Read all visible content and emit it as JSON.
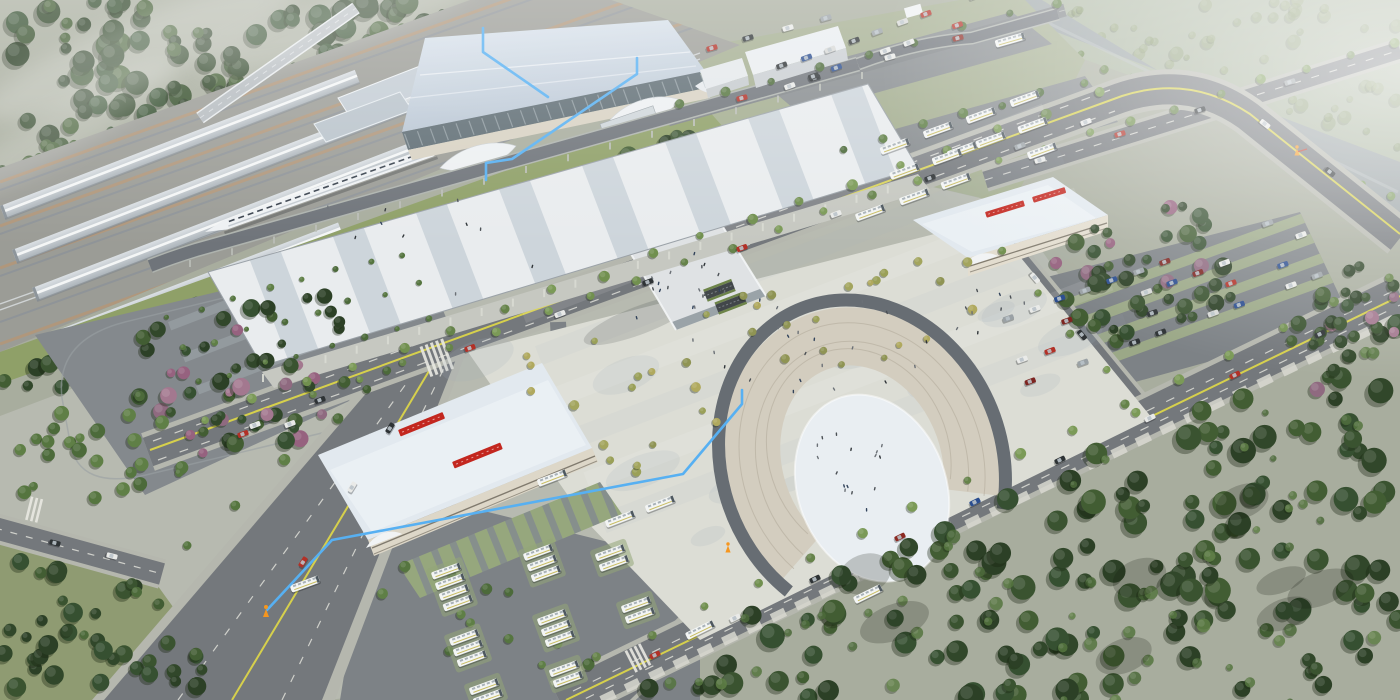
{
  "scene": {
    "type": "architectural-aerial-rendering",
    "subject": "High-speed railway station complex: station hall, platform canopies with train, striped arrival canopy, front plaza with oval horseshoe feature, bus terminal buildings, coach depot, parking lots, river and tree belts",
    "camera": "oblique bird's-eye view",
    "atmosphere": "hazy daylight"
  },
  "annotations": {
    "line_color": "#57b0f2",
    "marker_color": "#f6961e",
    "lines": [
      "station-roofline-left",
      "station-roofline-right",
      "plaza-to-bus-route"
    ],
    "markers": [
      "route-end-marker",
      "plaza-curb-marker",
      "riverside-marker"
    ]
  },
  "palette": {
    "station_roof_light": "#dde6ef",
    "station_roof_shade": "#b7c4d2",
    "canopy_stripe_light": "#e9ecee",
    "canopy_stripe_shade": "#cdd5db",
    "glass_facade": "#5f6d74",
    "building_sign_red": "#c3271f",
    "asphalt": "#74787c",
    "lane_yellow": "#d6d04c",
    "plaza_paving": "#dcddd5",
    "oval_path": "#676d73",
    "oval_infield": "#e9eef2",
    "river": "#99a2a4",
    "forest_dark": "#3a512c",
    "lawn": "#8fa068"
  }
}
